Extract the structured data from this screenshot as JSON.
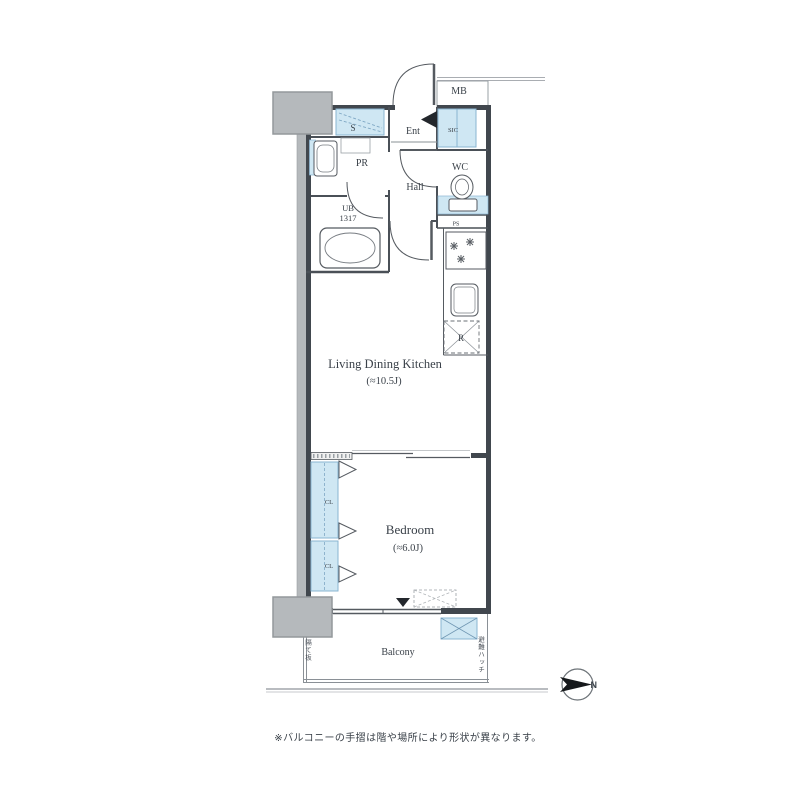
{
  "floor_plan": {
    "labels": {
      "mb": "MB",
      "s": "S",
      "ent": "Ent",
      "sic": "SIC",
      "pr": "PR",
      "wc": "WC",
      "hall": "Hall",
      "ub": "UB",
      "ub_size": "1317",
      "ps": "PS",
      "r": "R",
      "ldk": "Living Dining Kitchen",
      "ldk_size": "(≈10.5J)",
      "bedroom": "Bedroom",
      "bedroom_size": "(≈6.0J)",
      "cl_upper": "CL",
      "cl_lower": "CL",
      "balcony": "Balcony",
      "north": "N"
    },
    "annotations": {
      "balcony_left_vertical": "隔て板",
      "balcony_right_vertical": "避難ハッチ"
    },
    "caption": "※バルコニーの手摺は階や場所により形状が異なります。"
  },
  "colors": {
    "wall_dark": "#41474e",
    "line_thin": "#555a60",
    "line_light": "#9aa0a5",
    "water_blue_fill": "#cfe7f3",
    "water_blue_border": "#8ab5d2",
    "concrete_gray_fill": "#b5b9bc",
    "concrete_gray_border": "#94989b",
    "text": "#3a4149",
    "background": "#ffffff"
  }
}
